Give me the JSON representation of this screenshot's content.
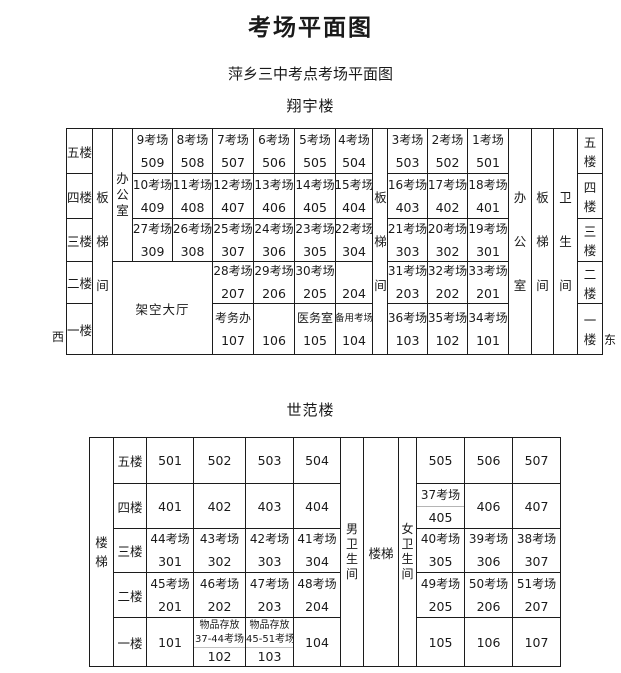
{
  "page": {
    "title": "考场平面图",
    "subtitle": "萍乡三中考点考场平面图",
    "west": "西",
    "east": "东"
  },
  "xiangyu": {
    "heading": "翔宇楼",
    "floors": [
      "五楼",
      "四楼",
      "三楼",
      "二楼",
      "一楼"
    ],
    "labels": {
      "stair": "板梯间",
      "office": "办公室",
      "toilet": "卫生间",
      "hall": "架空大厅"
    },
    "f5": [
      {
        "name": "9考场",
        "room": "509"
      },
      {
        "name": "8考场",
        "room": "508"
      },
      {
        "name": "7考场",
        "room": "507"
      },
      {
        "name": "6考场",
        "room": "506"
      },
      {
        "name": "5考场",
        "room": "505"
      },
      {
        "name": "4考场",
        "room": "504"
      },
      {
        "name": "3考场",
        "room": "503"
      },
      {
        "name": "2考场",
        "room": "502"
      },
      {
        "name": "1考场",
        "room": "501"
      }
    ],
    "f4": [
      {
        "name": "10考场",
        "room": "409"
      },
      {
        "name": "11考场",
        "room": "408"
      },
      {
        "name": "12考场",
        "room": "407"
      },
      {
        "name": "13考场",
        "room": "406"
      },
      {
        "name": "14考场",
        "room": "405"
      },
      {
        "name": "15考场",
        "room": "404"
      },
      {
        "name": "16考场",
        "room": "403"
      },
      {
        "name": "17考场",
        "room": "402"
      },
      {
        "name": "18考场",
        "room": "401"
      }
    ],
    "f3": [
      {
        "name": "27考场",
        "room": "309"
      },
      {
        "name": "26考场",
        "room": "308"
      },
      {
        "name": "25考场",
        "room": "307"
      },
      {
        "name": "24考场",
        "room": "306"
      },
      {
        "name": "23考场",
        "room": "305"
      },
      {
        "name": "22考场",
        "room": "304"
      },
      {
        "name": "21考场",
        "room": "303"
      },
      {
        "name": "20考场",
        "room": "302"
      },
      {
        "name": "19考场",
        "room": "301"
      }
    ],
    "f2": [
      {
        "name": "28考场",
        "room": "207"
      },
      {
        "name": "29考场",
        "room": "206"
      },
      {
        "name": "30考场",
        "room": "205"
      },
      {
        "name": "",
        "room": "204"
      },
      {
        "name": "31考场",
        "room": "203"
      },
      {
        "name": "32考场",
        "room": "202"
      },
      {
        "name": "33考场",
        "room": "201"
      }
    ],
    "f1": [
      {
        "name": "考务办",
        "room": "107"
      },
      {
        "name": "",
        "room": "106"
      },
      {
        "name": "医务室",
        "room": "105"
      },
      {
        "name": "备用考场",
        "room": "104"
      },
      {
        "name": "36考场",
        "room": "103"
      },
      {
        "name": "35考场",
        "room": "102"
      },
      {
        "name": "34考场",
        "room": "101"
      }
    ]
  },
  "shifan": {
    "heading": "世范楼",
    "floors": [
      "五楼",
      "四楼",
      "三楼",
      "二楼",
      "一楼"
    ],
    "labels": {
      "stair_left": "楼梯",
      "stair_mid": "楼梯",
      "male_wc": "男卫生间",
      "female_wc": "女卫生间"
    },
    "f5": [
      "501",
      "502",
      "503",
      "504",
      "505",
      "506",
      "507"
    ],
    "f4": {
      "left": [
        "401",
        "402",
        "403",
        "404"
      ],
      "split": {
        "name": "37考场",
        "room": "405"
      },
      "right": [
        "406",
        "407"
      ]
    },
    "f3": [
      {
        "name": "44考场",
        "room": "301"
      },
      {
        "name": "43考场",
        "room": "302"
      },
      {
        "name": "42考场",
        "room": "303"
      },
      {
        "name": "41考场",
        "room": "304"
      },
      {
        "name": "40考场",
        "room": "305"
      },
      {
        "name": "39考场",
        "room": "306"
      },
      {
        "name": "38考场",
        "room": "307"
      }
    ],
    "f2": [
      {
        "name": "45考场",
        "room": "201"
      },
      {
        "name": "46考场",
        "room": "202"
      },
      {
        "name": "47考场",
        "room": "203"
      },
      {
        "name": "48考场",
        "room": "204"
      },
      {
        "name": "49考场",
        "room": "205"
      },
      {
        "name": "50考场",
        "room": "206"
      },
      {
        "name": "51考场",
        "room": "207"
      }
    ],
    "f1": {
      "c1": "101",
      "store1": {
        "line1": "物品存放",
        "line2": "37-44考场",
        "room": "102"
      },
      "store2": {
        "line1": "物品存放",
        "line2": "45-51考场",
        "room": "103"
      },
      "c4": "104",
      "c5": "105",
      "c6": "106",
      "c7": "107"
    }
  }
}
